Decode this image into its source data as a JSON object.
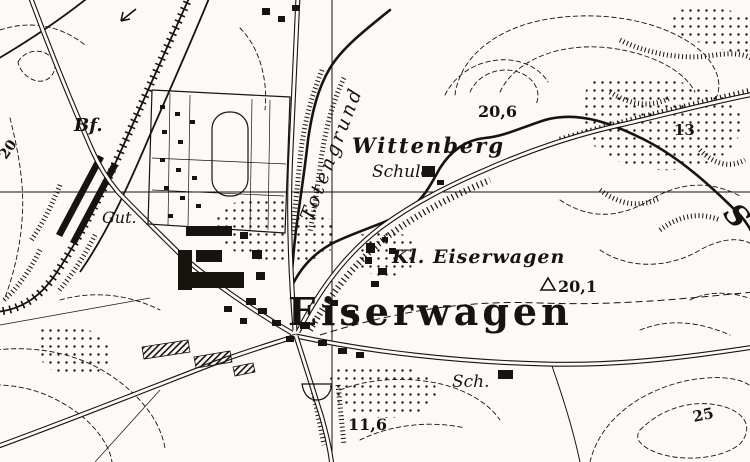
{
  "map": {
    "kind": "historical topographic map (German Messtischblatt style)",
    "ink_color": "#17130e",
    "paper_color": "#fbfaf6",
    "labels": {
      "settlement_main": "Eiserwagen",
      "settlement_small": "Kl. Eiserwagen",
      "hill_name": "Wittenberg",
      "school": "Schule",
      "school_abbr": "Sch.",
      "valley_name": "Totengrund",
      "station_abbr": "Bf.",
      "estate_abbr": "Gut.",
      "river_partial": "S"
    },
    "elevations": {
      "spot_height_north": "20,6",
      "trig_point": "20,1",
      "spot_height_northeast": "13",
      "spot_height_south": "11,6",
      "contour_west": "20",
      "contour_southeast": "25"
    },
    "symbols": {
      "trig_triangle": "triangulation-triangle",
      "railway_station_bars": "station-platform-bars",
      "direction_arrow": "railway-direction-arrow"
    }
  }
}
